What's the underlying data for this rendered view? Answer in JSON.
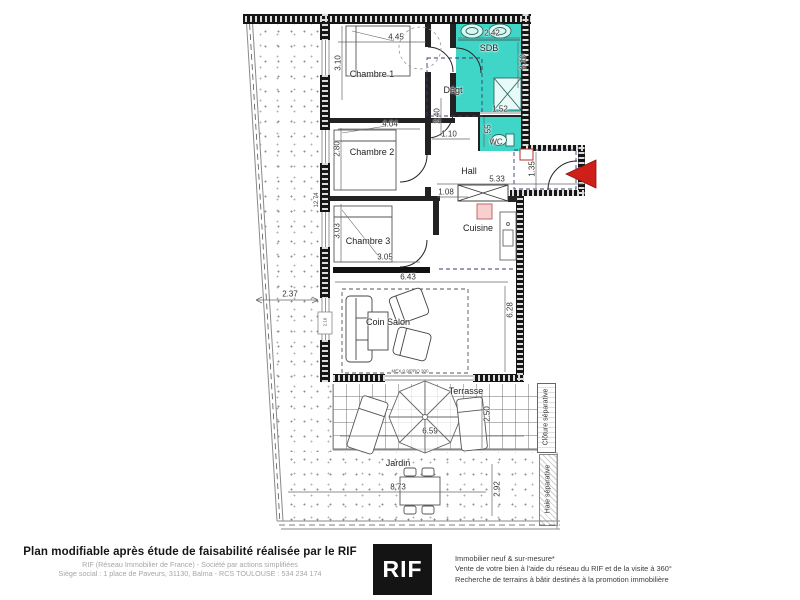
{
  "plan": {
    "rooms": {
      "chambre1": "Chambre 1",
      "chambre2": "Chambre 2",
      "chambre3": "Chambre 3",
      "sdb": "SDB",
      "degt": "Dégt",
      "wc": "WC",
      "hall": "Hall",
      "cuisine": "Cuisine",
      "coin_salon": "Coin Salon",
      "terrasse": "Terrasse",
      "jardin": "Jardin"
    },
    "dims": {
      "chambre1_w": "4.45",
      "chambre1_h": "3.10",
      "sdb_w": "2.42",
      "sdb_h": "3.10",
      "chambre2_w": "4.04",
      "chambre2_h": "2.80",
      "wc_w": "1.52",
      "wc_h": ".55",
      "degt_h": "2.40",
      "degt_pass": "1.10",
      "hall_w": "5.33",
      "hall_pass": "1.08",
      "entry_h": "1.35",
      "chambre3_w": "3.05",
      "chambre3_h": "3.03",
      "sejour_w": "6.43",
      "sejour_h": "6.28",
      "garden_left": "2.37",
      "building_h": "12.74",
      "salon_window": "2.16",
      "terrasse_w": "6.59",
      "terrasse_h": "2.50",
      "jardin_w": "8.73",
      "jardin_h": "2.92",
      "bay_label": "MEX 0.9/PRO 300"
    },
    "boundaries": {
      "cloture": "Clôture séparative",
      "haie": "Haie séparative"
    },
    "colors": {
      "wet_room_fill": "#3fd6c8",
      "entry_arrow": "#ce2018",
      "wall": "#161616"
    }
  },
  "footer": {
    "main": "Plan modifiable après étude de faisabilité réalisée par le RIF",
    "sub1": "RIF (Réseau Immobilier de France) - Société par actions simplifiées",
    "sub2": "Siège social : 1 place de Paveurs, 31130, Balma - RCS TOULOUSE : 534 234 174",
    "logo": "RIF",
    "right1": "Immobilier neuf & sur-mesure*",
    "right2": "Vente de votre bien à l'aide du réseau du RIF et de la visite à 360°",
    "right3": "Recherche de terrains à bâtir destinés à la promotion immobilière"
  }
}
